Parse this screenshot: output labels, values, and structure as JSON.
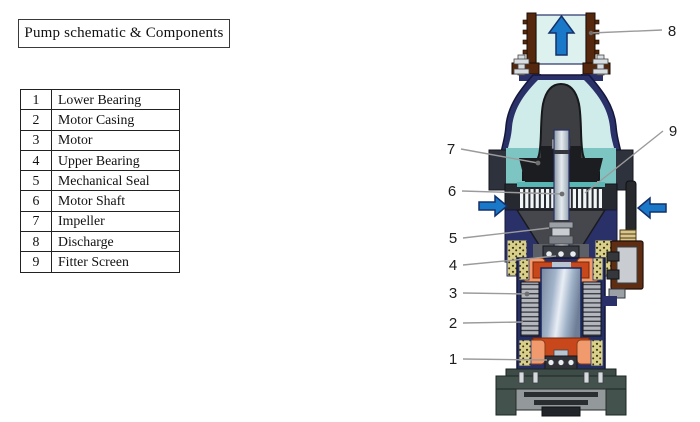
{
  "title": "Pump schematic & Components",
  "components": [
    {
      "num": "1",
      "name": "Lower Bearing"
    },
    {
      "num": "2",
      "name": "Motor Casing"
    },
    {
      "num": "3",
      "name": "Motor"
    },
    {
      "num": "4",
      "name": "Upper Bearing"
    },
    {
      "num": "5",
      "name": "Mechanical Seal"
    },
    {
      "num": "6",
      "name": "Motor Shaft"
    },
    {
      "num": "7",
      "name": "Impeller"
    },
    {
      "num": "8",
      "name": "Discharge"
    },
    {
      "num": "9",
      "name": "Fitter Screen"
    }
  ],
  "diagram": {
    "callouts": [
      {
        "num": "1",
        "target": "Lower Bearing"
      },
      {
        "num": "2",
        "target": "Motor Casing"
      },
      {
        "num": "3",
        "target": "Motor"
      },
      {
        "num": "4",
        "target": "Upper Bearing"
      },
      {
        "num": "5",
        "target": "Mechanical Seal"
      },
      {
        "num": "6",
        "target": "Motor Shaft"
      },
      {
        "num": "7",
        "target": "Impeller"
      },
      {
        "num": "8",
        "target": "Discharge"
      },
      {
        "num": "9",
        "target": "Fitter Screen"
      }
    ],
    "icons": {
      "discharge_arrow": "up-arrow",
      "inlet_left_arrow": "right-arrow",
      "inlet_right_arrow": "left-arrow"
    }
  },
  "colors": {
    "arrow_blue": "#1a78c8",
    "arrow_outline": "#14306a",
    "teal": "#7cc5c2",
    "navy": "#2a3168",
    "winding_orange": "#c8481c",
    "winding_coral": "#f09a6e",
    "thread_brown": "#55280e",
    "base_slate": "#43524d",
    "leader_gray": "#9b9b9b"
  }
}
